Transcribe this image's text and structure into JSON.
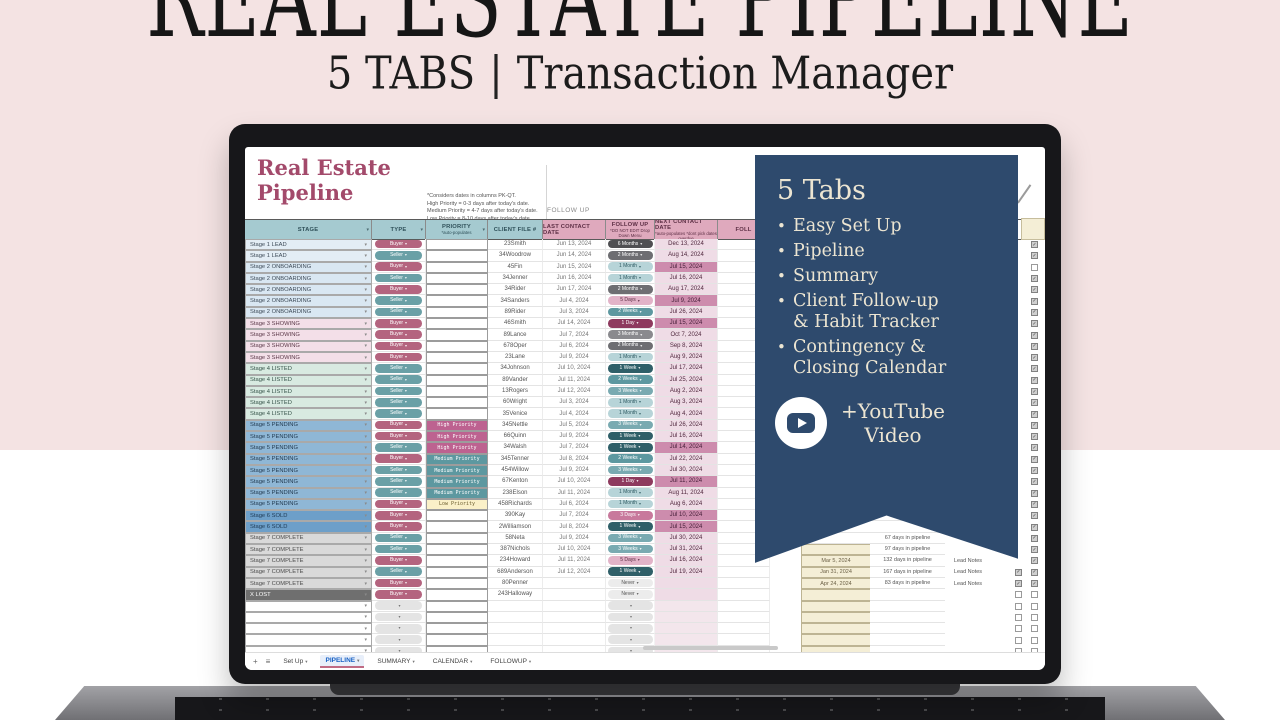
{
  "hero": {
    "title": "REAL ESTATE PIPELINE",
    "subtitle_left": "5 TABS",
    "separator": "|",
    "subtitle_right": "Transaction Manager"
  },
  "banner": {
    "heading": "5 Tabs",
    "bullets": [
      "Easy Set Up",
      "Pipeline",
      "Summary",
      "Client Follow-up\n& Habit Tracker",
      "Contingency &\nClosing Calendar"
    ],
    "youtube_label": "+YouTube\nVideo"
  },
  "sheet": {
    "logo_title": "Real Estate\n Pipeline",
    "note_lines": "*Considers dates in columns PK-QT.\nHigh Priority = 0-3 days after today's date.\nMedium Priority = 4-7 days after today's date.\nLow Priority = 8-10 days after today's date.",
    "section_label": "FOLLOW UP",
    "columns": [
      {
        "label": "STAGE",
        "sub": "",
        "theme": "teal",
        "w": 127,
        "arrow": true
      },
      {
        "label": "TYPE",
        "sub": "",
        "theme": "teal",
        "w": 54,
        "arrow": true
      },
      {
        "label": "PRIORITY",
        "sub": "*auto-populates",
        "theme": "teal",
        "w": 62,
        "arrow": true
      },
      {
        "label": "CLIENT FILE #",
        "sub": "",
        "theme": "teal",
        "w": 55,
        "arrow": false
      },
      {
        "label": "LAST CONTACT DATE",
        "sub": "",
        "theme": "pink",
        "w": 63,
        "arrow": false
      },
      {
        "label": "FOLLOW UP",
        "sub": "*DO NOT EDIT Drop Down Menu",
        "theme": "pink",
        "w": 49,
        "arrow": false
      },
      {
        "label": "NEXT CONTACT DATE",
        "sub": "*auto-populates *dont pick dates overdue",
        "theme": "pink",
        "w": 63,
        "arrow": false
      },
      {
        "label": "FOLL",
        "sub": "",
        "theme": "pink",
        "w": 52,
        "arrow": false
      }
    ],
    "rows": [
      {
        "stage": "Stage 1 LEAD",
        "sk": "s1",
        "type": "Buyer",
        "priority": "",
        "client": "23Smith",
        "last": "Jun 13, 2024",
        "follow": "6 Months",
        "next": "Dec 13, 2024",
        "hl": false,
        "cb": true
      },
      {
        "stage": "Stage 1 LEAD",
        "sk": "s1",
        "type": "Seller",
        "priority": "",
        "client": "34Woodrow",
        "last": "Jun 14, 2024",
        "follow": "2 Months",
        "next": "Aug 14, 2024",
        "hl": false,
        "cb": true
      },
      {
        "stage": "Stage 2 ONBOARDING",
        "sk": "s2",
        "type": "Buyer",
        "priority": "",
        "client": "45Fin",
        "last": "Jun 15, 2024",
        "follow": "1 Month",
        "next": "Jul 15, 2024",
        "hl": true,
        "cb": false
      },
      {
        "stage": "Stage 2 ONBOARDING",
        "sk": "s2",
        "type": "Seller",
        "priority": "",
        "client": "34Jenner",
        "last": "Jun 16, 2024",
        "follow": "1 Month",
        "next": "Jul 16, 2024",
        "hl": false,
        "cb": true
      },
      {
        "stage": "Stage 2 ONBOARDING",
        "sk": "s2",
        "type": "Buyer",
        "priority": "",
        "client": "34Rider",
        "last": "Jun 17, 2024",
        "follow": "2 Months",
        "next": "Aug 17, 2024",
        "hl": false,
        "cb": true
      },
      {
        "stage": "Stage 2 ONBOARDING",
        "sk": "s2",
        "type": "Seller",
        "priority": "",
        "client": "34Sanders",
        "last": "Jul 4, 2024",
        "follow": "5 Days",
        "next": "Jul 9, 2024",
        "hl": true,
        "cb": true
      },
      {
        "stage": "Stage 2 ONBOARDING",
        "sk": "s2",
        "type": "Seller",
        "priority": "",
        "client": "89Rider",
        "last": "Jul 3, 2024",
        "follow": "2 Weeks",
        "next": "Jul 26, 2024",
        "hl": false,
        "cb": true
      },
      {
        "stage": "Stage 3 SHOWING",
        "sk": "s3",
        "type": "Buyer",
        "priority": "",
        "client": "46Smith",
        "last": "Jul 14, 2024",
        "follow": "1 Day",
        "next": "Jul 15, 2024",
        "hl": true,
        "cb": true
      },
      {
        "stage": "Stage 3 SHOWING",
        "sk": "s3",
        "type": "Buyer",
        "priority": "",
        "client": "89Lance",
        "last": "Jul 7, 2024",
        "follow": "3 Months",
        "next": "Oct 7, 2024",
        "hl": false,
        "cb": true
      },
      {
        "stage": "Stage 3 SHOWING",
        "sk": "s3",
        "type": "Buyer",
        "priority": "",
        "client": "678Oper",
        "last": "Jul 6, 2024",
        "follow": "2 Months",
        "next": "Sep 8, 2024",
        "hl": false,
        "cb": true
      },
      {
        "stage": "Stage 3 SHOWING",
        "sk": "s3",
        "type": "Buyer",
        "priority": "",
        "client": "23Lane",
        "last": "Jul 9, 2024",
        "follow": "1 Month",
        "next": "Aug 9, 2024",
        "hl": false,
        "cb": true
      },
      {
        "stage": "Stage 4 LISTED",
        "sk": "s4",
        "type": "Seller",
        "priority": "",
        "client": "34Johnson",
        "last": "Jul 10, 2024",
        "follow": "1 Week",
        "next": "Jul 17, 2024",
        "hl": false,
        "cb": true
      },
      {
        "stage": "Stage 4 LISTED",
        "sk": "s4",
        "type": "Seller",
        "priority": "",
        "client": "89Vander",
        "last": "Jul 11, 2024",
        "follow": "2 Weeks",
        "next": "Jul 25, 2024",
        "hl": false,
        "cb": true
      },
      {
        "stage": "Stage 4 LISTED",
        "sk": "s4",
        "type": "Seller",
        "priority": "",
        "client": "13Rogers",
        "last": "Jul 12, 2024",
        "follow": "3 Weeks",
        "next": "Aug 2, 2024",
        "hl": false,
        "cb": true
      },
      {
        "stage": "Stage 4 LISTED",
        "sk": "s4",
        "type": "Seller",
        "priority": "",
        "client": "60Wright",
        "last": "Jul 3, 2024",
        "follow": "1 Month",
        "next": "Aug 3, 2024",
        "hl": false,
        "cb": true
      },
      {
        "stage": "Stage 4 LISTED",
        "sk": "s4",
        "type": "Seller",
        "priority": "",
        "client": "35Venice",
        "last": "Jul 4, 2024",
        "follow": "1 Month",
        "next": "Aug 4, 2024",
        "hl": false,
        "cb": true
      },
      {
        "stage": "Stage 5 PENDING",
        "sk": "s5",
        "type": "Buyer",
        "priority": "High Priority",
        "client": "345Nettle",
        "last": "Jul 5, 2024",
        "follow": "3 Weeks",
        "next": "Jul 26, 2024",
        "hl": false,
        "cb": true
      },
      {
        "stage": "Stage 5 PENDING",
        "sk": "s5",
        "type": "Buyer",
        "priority": "High Priority",
        "client": "66Quinn",
        "last": "Jul 9, 2024",
        "follow": "1 Week",
        "next": "Jul 16, 2024",
        "hl": false,
        "cb": true
      },
      {
        "stage": "Stage 5 PENDING",
        "sk": "s5",
        "type": "Seller",
        "priority": "High Priority",
        "client": "34Walsh",
        "last": "Jul 7, 2024",
        "follow": "1 Week",
        "next": "Jul 14, 2024",
        "hl": true,
        "cb": true
      },
      {
        "stage": "Stage 5 PENDING",
        "sk": "s5",
        "type": "Buyer",
        "priority": "Medium Priority",
        "client": "345Tenner",
        "last": "Jul 8, 2024",
        "follow": "2 Weeks",
        "next": "Jul 22, 2024",
        "hl": false,
        "cb": true
      },
      {
        "stage": "Stage 5 PENDING",
        "sk": "s5",
        "type": "Seller",
        "priority": "Medium Priority",
        "client": "454Willow",
        "last": "Jul 9, 2024",
        "follow": "3 Weeks",
        "next": "Jul 30, 2024",
        "hl": false,
        "cb": true
      },
      {
        "stage": "Stage 5 PENDING",
        "sk": "s5",
        "type": "Seller",
        "priority": "Medium Priority",
        "client": "67Kenton",
        "last": "Jul 10, 2024",
        "follow": "1 Day",
        "next": "Jul 11, 2024",
        "hl": true,
        "cb": true
      },
      {
        "stage": "Stage 5 PENDING",
        "sk": "s5",
        "type": "Seller",
        "priority": "Medium Priority",
        "client": "238Elson",
        "last": "Jul 11, 2024",
        "follow": "1 Month",
        "next": "Aug 11, 2024",
        "hl": false,
        "cb": true
      },
      {
        "stage": "Stage 5 PENDING",
        "sk": "s5",
        "type": "Buyer",
        "priority": "Low Priority",
        "client": "458Richards",
        "last": "Jul 6, 2024",
        "follow": "1 Month",
        "next": "Aug 6, 2024",
        "hl": false,
        "cb": true
      },
      {
        "stage": "Stage 6 SOLD",
        "sk": "s6",
        "type": "Buyer",
        "priority": "",
        "client": "390Kay",
        "last": "Jul 7, 2024",
        "follow": "3 Days",
        "next": "Jul 10, 2024",
        "hl": true,
        "cb": true
      },
      {
        "stage": "Stage 6 SOLD",
        "sk": "s6",
        "type": "Buyer",
        "priority": "",
        "client": "2Williamson",
        "last": "Jul 8, 2024",
        "follow": "1 Week",
        "next": "Jul 15, 2024",
        "hl": true,
        "cb": true
      },
      {
        "stage": "Stage 7 COMPLETE",
        "sk": "s7",
        "type": "Seller",
        "priority": "",
        "client": "58Neta",
        "last": "Jul 9, 2024",
        "follow": "3 Weeks",
        "next": "Jul 30, 2024",
        "hl": false,
        "cb": true,
        "days": "67 days in pipeline"
      },
      {
        "stage": "Stage 7 COMPLETE",
        "sk": "s7",
        "type": "Seller",
        "priority": "",
        "client": "387Nichols",
        "last": "Jul 10, 2024",
        "follow": "3 Weeks",
        "next": "Jul 31, 2024",
        "hl": false,
        "cb": true,
        "rdate": "",
        "days": "97 days in pipeline"
      },
      {
        "stage": "Stage 7 COMPLETE",
        "sk": "s7",
        "type": "Buyer",
        "priority": "",
        "client": "234Howard",
        "last": "Jul 11, 2024",
        "follow": "5 Days",
        "next": "Jul 16, 2024",
        "hl": false,
        "cb": true,
        "rdate": "Mar 5, 2024",
        "days": "132 days in pipeline",
        "note": "Lead Notes"
      },
      {
        "stage": "Stage 7 COMPLETE",
        "sk": "s7",
        "type": "Seller",
        "priority": "",
        "client": "689Anderson",
        "last": "Jul 12, 2024",
        "follow": "1 Week",
        "next": "Jul 19, 2024",
        "hl": false,
        "cb": true,
        "cb2": true,
        "rdate": "Jan 31, 2024",
        "days": "167 days in pipeline",
        "note": "Lead Notes"
      },
      {
        "stage": "Stage 7 COMPLETE",
        "sk": "s7",
        "type": "Buyer",
        "priority": "",
        "client": "80Penner",
        "last": "",
        "follow": "Never",
        "next": "",
        "hl": false,
        "cb": true,
        "cb2": true,
        "rdate": "Apr 24, 2024",
        "days": "83 days in pipeline",
        "note": "Lead Notes"
      },
      {
        "stage": "X LOST",
        "sk": "sx",
        "type": "Buyer",
        "priority": "",
        "client": "243Halloway",
        "last": "",
        "follow": "Never",
        "next": "",
        "hl": false,
        "cb": false,
        "cb2": false,
        "rdate": ""
      }
    ],
    "empty_row_count": 5,
    "tabbar": {
      "plus_icon": "+",
      "menu_icon": "≡",
      "tabs": [
        "Set Up",
        "PIPELINE",
        "SUMMARY",
        "CALENDAR",
        "FOLLOWUP"
      ],
      "active_tab": "PIPELINE"
    }
  },
  "colors": {
    "background_top": "#f4e3e3",
    "background_bottom": "#ffffff",
    "banner": "#2e4a6d",
    "banner_text": "#ece5d2",
    "sheet_title": "#a34a6b",
    "header_teal": "#a5cad0",
    "header_pink": "#dfa9bd",
    "next_cell": "#efdce6",
    "next_cell_highlight": "#cd8cad",
    "stage": {
      "s1": "#e3edf5",
      "s2": "#d9e7f2",
      "s3": "#f3dfe8",
      "s4": "#d8eae1",
      "s5": "#8fb7d6",
      "s6": "#6d9fc9",
      "s7": "#d9d9d9",
      "sx": "#6f6f6f"
    },
    "stage_text": {
      "s1": "#3e4b58",
      "s2": "#3e4b58",
      "s3": "#5d3a4a",
      "s4": "#37544a",
      "s5": "#243c52",
      "s6": "#1f3a55",
      "s7": "#4c4c4c",
      "sx": "#ffffff"
    },
    "type": {
      "Buyer": "#b4647f",
      "Seller": "#6aa0a6"
    },
    "priority": {
      "High Priority": [
        "#bd6290",
        "#ffffff"
      ],
      "Medium Priority": [
        "#5d98a0",
        "#ffffff"
      ],
      "Low Priority": [
        "#faf0c8",
        "#6b5d2e"
      ]
    },
    "follow": {
      "6 Months": [
        "#4f4f52",
        "#ffffff"
      ],
      "3 Months": [
        "#8a8a8e",
        "#ffffff"
      ],
      "2 Months": [
        "#6e6e72",
        "#ffffff"
      ],
      "1 Month": [
        "#b7d4d8",
        "#2f5b63"
      ],
      "3 Weeks": [
        "#79aab1",
        "#ffffff"
      ],
      "2 Weeks": [
        "#5d98a0",
        "#ffffff"
      ],
      "1 Week": [
        "#2f5f68",
        "#ffffff"
      ],
      "5 Days": [
        "#e2b3c8",
        "#5a2c42"
      ],
      "3 Days": [
        "#c8799c",
        "#ffffff"
      ],
      "1 Day": [
        "#8e3a5e",
        "#ffffff"
      ],
      "Never": [
        "#ececec",
        "#555555"
      ]
    }
  }
}
